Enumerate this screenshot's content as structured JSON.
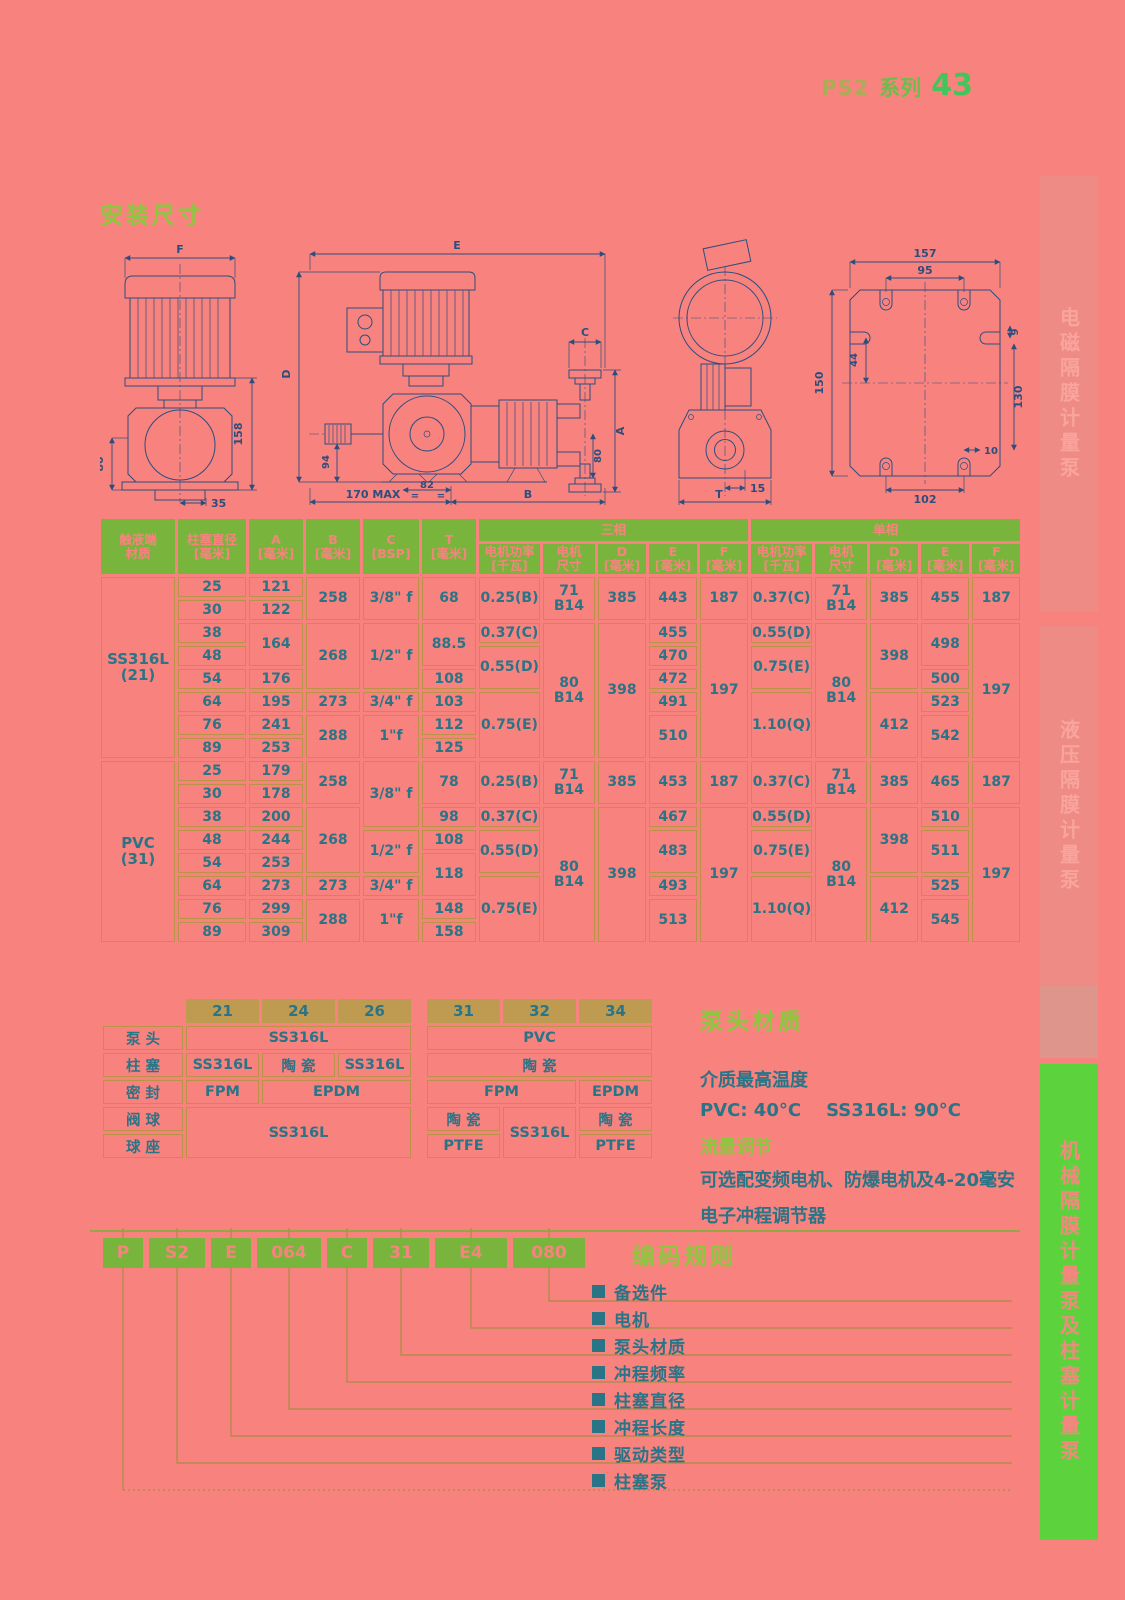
{
  "page": {
    "series": "PS2",
    "series_word": "系列",
    "page_no": "43",
    "install_title": "安装尺寸"
  },
  "colors": {
    "background": "#F8827E",
    "header_green": "#79B43D",
    "lime_heading": "#8DC63F",
    "tan_border": "#BA9348",
    "tan_header": "#BE9B50",
    "teal_text": "#2A7487",
    "drawing_navy": "#2B4E7E",
    "tab_pink": "#EE8B85",
    "tab_green": "#5CD33C"
  },
  "drawings": {
    "front": {
      "f": "F",
      "h158": "158",
      "h80": "80",
      "w35": "35"
    },
    "side": {
      "e": "E",
      "d": "D",
      "n94": "94",
      "c": "C",
      "a": "A",
      "n80": "80",
      "n82": "82",
      "eq1": "=",
      "eq2": "=",
      "max": "170 MAX",
      "b": "B"
    },
    "end": {
      "n15": "15",
      "t": "T"
    },
    "plate": {
      "n157": "157",
      "n95": "95",
      "n44": "44",
      "n150": "150",
      "n9": "9",
      "n130": "130",
      "n10": "10",
      "n102": "102"
    }
  },
  "main_table": {
    "widths": [
      74,
      68,
      54,
      54,
      56,
      54,
      56,
      52,
      48,
      48,
      48,
      56,
      52,
      48,
      48,
      48
    ],
    "head": [
      [
        {
          "t": "触液端\n材质",
          "r": 2
        },
        {
          "t": "柱塞直径\n[毫米]",
          "r": 2
        },
        {
          "t": "A\n[毫米]",
          "r": 2
        },
        {
          "t": "B\n[毫米]",
          "r": 2
        },
        {
          "t": "C\n[BSP]",
          "r": 2
        },
        {
          "t": "T\n[毫米]",
          "r": 2
        },
        {
          "t": "三相",
          "c": 5
        },
        {
          "t": "单相",
          "c": 5
        }
      ],
      [
        {
          "t": "电机功率\n[千瓦]"
        },
        {
          "t": "电机\n尺寸"
        },
        {
          "t": "D\n[毫米]"
        },
        {
          "t": "E\n[毫米]"
        },
        {
          "t": "F\n[毫米]"
        },
        {
          "t": "电机功率\n[千瓦]"
        },
        {
          "t": "电机\n尺寸"
        },
        {
          "t": "D\n[毫米]"
        },
        {
          "t": "E\n[毫米]"
        },
        {
          "t": "F\n[毫米]"
        }
      ]
    ],
    "body": [
      [
        {
          "t": "SS316L\n(21)",
          "r": 8,
          "k": "mat"
        },
        {
          "t": "25"
        },
        {
          "t": "121"
        },
        {
          "t": "258",
          "r": 2
        },
        {
          "t": "3/8\" f",
          "r": 2
        },
        {
          "t": "68",
          "r": 2
        },
        {
          "t": "0.25(B)",
          "r": 2
        },
        {
          "t": "71 B14",
          "r": 2
        },
        {
          "t": "385",
          "r": 2
        },
        {
          "t": "443",
          "r": 2
        },
        {
          "t": "187",
          "r": 2
        },
        {
          "t": "0.37(C)",
          "r": 2
        },
        {
          "t": "71 B14",
          "r": 2
        },
        {
          "t": "385",
          "r": 2
        },
        {
          "t": "455",
          "r": 2
        },
        {
          "t": "187",
          "r": 2
        }
      ],
      [
        {
          "t": "30"
        },
        {
          "t": "122"
        }
      ],
      [
        {
          "t": "38"
        },
        {
          "t": "164",
          "r": 2
        },
        {
          "t": "268",
          "r": 3
        },
        {
          "t": "1/2\" f",
          "r": 3
        },
        {
          "t": "88.5",
          "r": 2
        },
        {
          "t": "0.37(C)"
        },
        {
          "t": "80 B14",
          "r": 6
        },
        {
          "t": "398",
          "r": 6
        },
        {
          "t": "455"
        },
        {
          "t": "197",
          "r": 6
        },
        {
          "t": "0.55(D)"
        },
        {
          "t": "80 B14",
          "r": 6
        },
        {
          "t": "398",
          "r": 3
        },
        {
          "t": "498",
          "r": 2
        },
        {
          "t": "197",
          "r": 6
        }
      ],
      [
        {
          "t": "48"
        },
        {
          "t": "0.55(D)",
          "r": 2
        },
        {
          "t": "470"
        },
        {
          "t": "0.75(E)",
          "r": 2
        }
      ],
      [
        {
          "t": "54"
        },
        {
          "t": "176"
        },
        {
          "t": "108"
        },
        {
          "t": "472"
        },
        {
          "t": "500"
        }
      ],
      [
        {
          "t": "64"
        },
        {
          "t": "195"
        },
        {
          "t": "273"
        },
        {
          "t": "3/4\" f"
        },
        {
          "t": "103"
        },
        {
          "t": "0.75(E)",
          "r": 3
        },
        {
          "t": "491"
        },
        {
          "t": "1.10(Q)",
          "r": 3
        },
        {
          "t": "412",
          "r": 3
        },
        {
          "t": "523"
        }
      ],
      [
        {
          "t": "76"
        },
        {
          "t": "241"
        },
        {
          "t": "288",
          "r": 2
        },
        {
          "t": "1\"f",
          "r": 2
        },
        {
          "t": "112"
        },
        {
          "t": "510",
          "r": 2
        },
        {
          "t": "542",
          "r": 2
        }
      ],
      [
        {
          "t": "89"
        },
        {
          "t": "253"
        },
        {
          "t": "125"
        }
      ],
      [
        {
          "t": "PVC\n(31)",
          "r": 8,
          "k": "mat"
        },
        {
          "t": "25"
        },
        {
          "t": "179"
        },
        {
          "t": "258",
          "r": 2
        },
        {
          "t": "3/8\" f",
          "r": 3
        },
        {
          "t": "78",
          "r": 2
        },
        {
          "t": "0.25(B)",
          "r": 2
        },
        {
          "t": "71 B14",
          "r": 2
        },
        {
          "t": "385",
          "r": 2
        },
        {
          "t": "453",
          "r": 2
        },
        {
          "t": "187",
          "r": 2
        },
        {
          "t": "0.37(C)",
          "r": 2
        },
        {
          "t": "71 B14",
          "r": 2
        },
        {
          "t": "385",
          "r": 2
        },
        {
          "t": "465",
          "r": 2
        },
        {
          "t": "187",
          "r": 2
        }
      ],
      [
        {
          "t": "30"
        },
        {
          "t": "178"
        }
      ],
      [
        {
          "t": "38"
        },
        {
          "t": "200"
        },
        {
          "t": "268",
          "r": 3
        },
        {
          "t": "98"
        },
        {
          "t": "0.37(C)"
        },
        {
          "t": "80 B14",
          "r": 6
        },
        {
          "t": "398",
          "r": 6
        },
        {
          "t": "467"
        },
        {
          "t": "197",
          "r": 6
        },
        {
          "t": "0.55(D)"
        },
        {
          "t": "80 B14",
          "r": 6
        },
        {
          "t": "398",
          "r": 3
        },
        {
          "t": "510"
        },
        {
          "t": "197",
          "r": 6
        }
      ],
      [
        {
          "t": "48"
        },
        {
          "t": "244"
        },
        {
          "t": "1/2\" f",
          "r": 2
        },
        {
          "t": "108"
        },
        {
          "t": "0.55(D)",
          "r": 2
        },
        {
          "t": "483",
          "r": 2
        },
        {
          "t": "0.75(E)",
          "r": 2
        },
        {
          "t": "511",
          "r": 2
        }
      ],
      [
        {
          "t": "54"
        },
        {
          "t": "253"
        },
        {
          "t": "118",
          "r": 2
        }
      ],
      [
        {
          "t": "64"
        },
        {
          "t": "273"
        },
        {
          "t": "273"
        },
        {
          "t": "3/4\" f"
        },
        {
          "t": "0.75(E)",
          "r": 3
        },
        {
          "t": "493"
        },
        {
          "t": "1.10(Q)",
          "r": 3
        },
        {
          "t": "412",
          "r": 3
        },
        {
          "t": "525"
        }
      ],
      [
        {
          "t": "76"
        },
        {
          "t": "299"
        },
        {
          "t": "288",
          "r": 2
        },
        {
          "t": "1\"f",
          "r": 2
        },
        {
          "t": "148"
        },
        {
          "t": "513",
          "r": 2
        },
        {
          "t": "545",
          "r": 2
        }
      ],
      [
        {
          "t": "89"
        },
        {
          "t": "309"
        },
        {
          "t": "158"
        }
      ]
    ]
  },
  "material_table": {
    "widths": [
      80,
      73,
      73,
      73,
      10,
      73,
      73,
      73
    ],
    "head": [
      [
        {
          "t": "",
          "k": "sp"
        },
        {
          "t": "21"
        },
        {
          "t": "24"
        },
        {
          "t": "26"
        },
        {
          "t": "",
          "k": "sp"
        },
        {
          "t": "31"
        },
        {
          "t": "32"
        },
        {
          "t": "34"
        }
      ]
    ],
    "body": [
      [
        {
          "t": "泵 头",
          "k": "lbl"
        },
        {
          "t": "SS316L",
          "c": 3
        },
        {
          "t": "",
          "k": "sp"
        },
        {
          "t": "PVC",
          "c": 3
        }
      ],
      [
        {
          "t": "柱 塞",
          "k": "lbl"
        },
        {
          "t": "SS316L"
        },
        {
          "t": "陶 瓷"
        },
        {
          "t": "SS316L"
        },
        {
          "t": "",
          "k": "sp"
        },
        {
          "t": "陶 瓷",
          "c": 3
        }
      ],
      [
        {
          "t": "密 封",
          "k": "lbl"
        },
        {
          "t": "FPM"
        },
        {
          "t": "EPDM",
          "c": 2
        },
        {
          "t": "",
          "k": "sp"
        },
        {
          "t": "FPM",
          "c": 2
        },
        {
          "t": "EPDM"
        }
      ],
      [
        {
          "t": "阀 球",
          "k": "lbl"
        },
        {
          "t": "SS316L",
          "c": 3,
          "r": 2
        },
        {
          "t": "",
          "k": "sp",
          "r": 2
        },
        {
          "t": "陶 瓷"
        },
        {
          "t": "SS316L",
          "r": 2
        },
        {
          "t": "陶 瓷"
        }
      ],
      [
        {
          "t": "球 座",
          "k": "lbl"
        },
        {
          "t": "PTFE"
        },
        {
          "t": "PTFE"
        }
      ]
    ]
  },
  "info": {
    "title": "泵头材质",
    "temp_title": "介质最高温度",
    "temp_line": "PVC: 40°C    SS316L: 90°C",
    "flow_title": "流量调节",
    "flow_line1": "可选配变频电机、防爆电机及4-20毫安",
    "flow_line2": "电子冲程调节器"
  },
  "coding": {
    "title": "编码规则",
    "boxes": [
      "P",
      "S2",
      "E",
      "064",
      "C",
      "31",
      "E4",
      "080"
    ],
    "items": [
      "备选件",
      "电机",
      "泵头材质",
      "冲程频率",
      "柱塞直径",
      "冲程长度",
      "驱动类型",
      "柱塞泵"
    ]
  },
  "sidebar": {
    "tabs": [
      {
        "label": "电磁隔膜计量泵"
      },
      {
        "label": "液压隔膜计量泵"
      },
      {
        "label": "机械隔膜计量泵及柱塞计量泵"
      }
    ]
  }
}
